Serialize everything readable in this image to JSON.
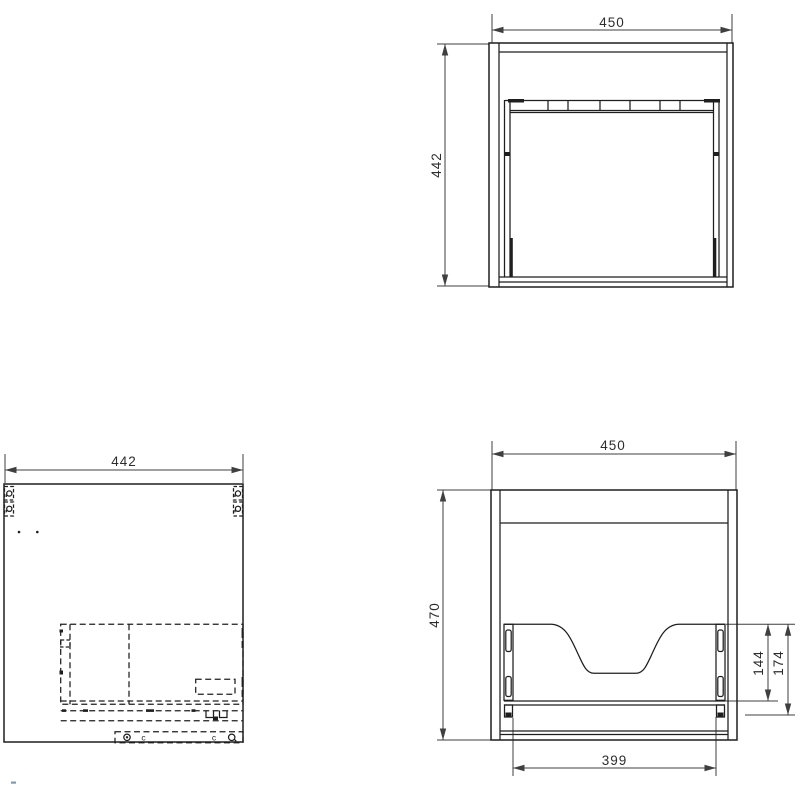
{
  "labels": {
    "carcass_front": {
      "width": "450",
      "height": "442"
    },
    "panel_plan": {
      "width": "442",
      "clip_label_left": "c",
      "clip_label_right": "c"
    },
    "drawer_front": {
      "width": "450",
      "height": "470",
      "runner_height": "144",
      "runner_bracket_height": "174",
      "drawer_width": "399"
    }
  },
  "colors": {
    "background": "#ffffff",
    "object_line": "#1f1f1f",
    "dim_line": "#3f3f3f",
    "text": "#2d2d2d",
    "stray_mark": "#7d9cb5"
  }
}
